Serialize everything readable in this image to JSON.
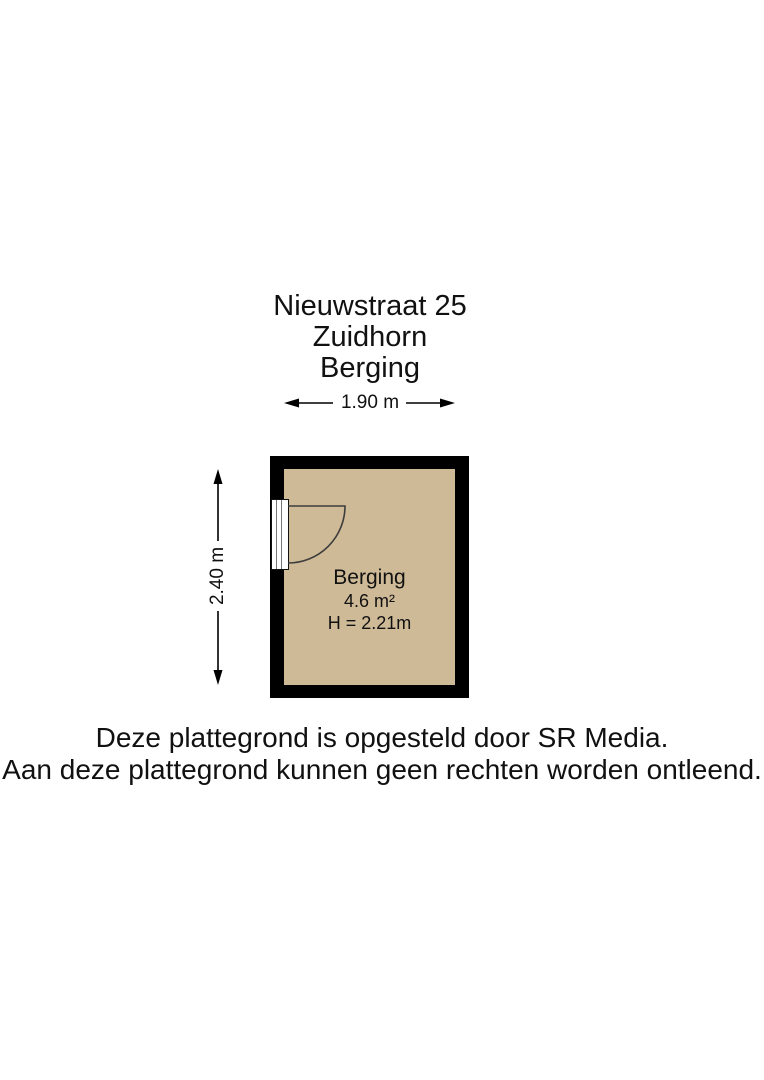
{
  "title": {
    "address": "Nieuwstraat 25",
    "city": "Zuidhorn",
    "room": "Berging"
  },
  "dimensions": {
    "width_label": "1.90 m",
    "height_label": "2.40 m"
  },
  "room": {
    "name": "Berging",
    "area": "4.6 m²",
    "ceiling_height": "H = 2.21m"
  },
  "footer": {
    "line1": "Deze plattegrond is opgesteld door SR Media.",
    "line2": "Aan deze plattegrond kunnen geen rechten worden ontleend."
  },
  "colors": {
    "wall": "#000000",
    "floor_fill": "#cfba97",
    "line": "#000000",
    "door_arc": "#3d3d3d",
    "text": "#111111"
  }
}
